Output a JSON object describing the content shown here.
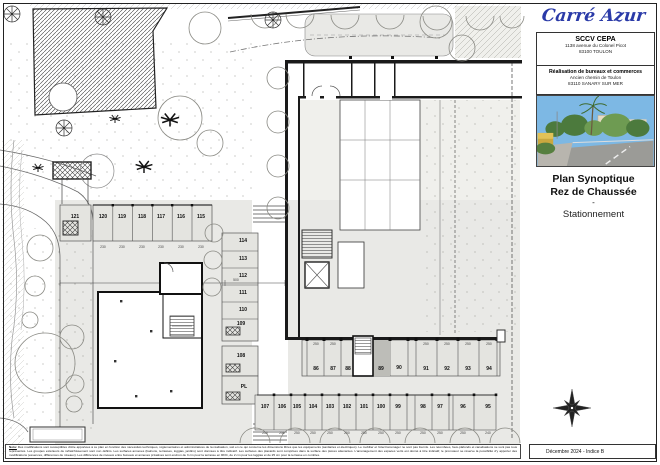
{
  "title_block": {
    "logo_text": "Carré Azur",
    "client_name": "SCCV CEPA",
    "client_address1": "1138 avenue du Colonel Picot",
    "client_address2": "83100 TOULON",
    "project_title": "Réalisation de bureaux et commerces",
    "project_address1": "Ancien chemin de Toulon",
    "project_address2": "83110 SANARY SUR MER",
    "drawing_title1": "Plan Synoptique",
    "drawing_title2": "Rez de Chaussée",
    "drawing_sep": "-",
    "drawing_subtitle": "Stationnement",
    "revision": "Décembre 2024 - Indice B"
  },
  "notes": {
    "label": "Nota:",
    "text": " Des modifications sont susceptibles d'être apportées à ce plan en fonction des nécessités techniques, réglementaires et administratives de la réalisation, soit en ce qui concerne les dimensions libres que les équipements (sanitaires et électriques). Le mobilier et l'électroménager ne sont pas fournis. Les retombées, faux-plafonds et canalisations ne sont pas tous représentés. Les groupes extérieurs de rafraîchissement sont non définis. Les surfaces annexes (balcons, terrasses, loggias, jardins) sont données à titre indicatif. Les surfaces des placards sont comprises dans la surface des pièces attenantes. L'aménagement des espaces verts est donné à titre indicatif, le promoteur se réserve la possibilité d'y apporter des modifications (essences, différences de niveaux). Les différences de niveaux entre bureaux et annexes privatives sont environ de 3 cm pour la terrasse en RDC, de 2 cm pour les loggias et de 25 cm pour la terrasse en combles."
  },
  "plan": {
    "labels": [
      {
        "t": "121",
        "x": 75,
        "y": 217,
        "k": "s"
      },
      {
        "t": "120",
        "x": 103,
        "y": 217,
        "k": "s"
      },
      {
        "t": "119",
        "x": 122,
        "y": 217,
        "k": "s"
      },
      {
        "t": "118",
        "x": 142,
        "y": 217,
        "k": "s"
      },
      {
        "t": "117",
        "x": 161,
        "y": 217,
        "k": "s"
      },
      {
        "t": "116",
        "x": 181,
        "y": 217,
        "k": "s"
      },
      {
        "t": "115",
        "x": 201,
        "y": 217,
        "k": "s"
      },
      {
        "t": "114",
        "x": 243,
        "y": 241,
        "k": "s"
      },
      {
        "t": "113",
        "x": 243,
        "y": 259,
        "k": "s"
      },
      {
        "t": "112",
        "x": 243,
        "y": 276,
        "k": "s"
      },
      {
        "t": "111",
        "x": 243,
        "y": 293,
        "k": "s"
      },
      {
        "t": "110",
        "x": 243,
        "y": 310,
        "k": "s"
      },
      {
        "t": "109",
        "x": 241,
        "y": 324,
        "k": "s"
      },
      {
        "t": "108",
        "x": 241,
        "y": 356,
        "k": "s"
      },
      {
        "t": "PL",
        "x": 244,
        "y": 387,
        "k": "s"
      },
      {
        "t": "86",
        "x": 316,
        "y": 369,
        "k": "s"
      },
      {
        "t": "87",
        "x": 333,
        "y": 369,
        "k": "s"
      },
      {
        "t": "88",
        "x": 348,
        "y": 369,
        "k": "s"
      },
      {
        "t": "89",
        "x": 381,
        "y": 369,
        "k": "s"
      },
      {
        "t": "90",
        "x": 399,
        "y": 368,
        "k": "s"
      },
      {
        "t": "91",
        "x": 426,
        "y": 369,
        "k": "s"
      },
      {
        "t": "92",
        "x": 447,
        "y": 369,
        "k": "s"
      },
      {
        "t": "93",
        "x": 468,
        "y": 369,
        "k": "s"
      },
      {
        "t": "94",
        "x": 489,
        "y": 369,
        "k": "s"
      },
      {
        "t": "107",
        "x": 265,
        "y": 407,
        "k": "s"
      },
      {
        "t": "106",
        "x": 282,
        "y": 407,
        "k": "s"
      },
      {
        "t": "105",
        "x": 297,
        "y": 407,
        "k": "s"
      },
      {
        "t": "104",
        "x": 313,
        "y": 407,
        "k": "s"
      },
      {
        "t": "103",
        "x": 330,
        "y": 407,
        "k": "s"
      },
      {
        "t": "102",
        "x": 347,
        "y": 407,
        "k": "s"
      },
      {
        "t": "101",
        "x": 364,
        "y": 407,
        "k": "s"
      },
      {
        "t": "100",
        "x": 381,
        "y": 407,
        "k": "s"
      },
      {
        "t": "99",
        "x": 398,
        "y": 407,
        "k": "s"
      },
      {
        "t": "98",
        "x": 423,
        "y": 407,
        "k": "s"
      },
      {
        "t": "97",
        "x": 440,
        "y": 407,
        "k": "s"
      },
      {
        "t": "96",
        "x": 463,
        "y": 407,
        "k": "s"
      },
      {
        "t": "95",
        "x": 488,
        "y": 407,
        "k": "s"
      },
      {
        "t": "230",
        "x": 103,
        "y": 247,
        "k": "d"
      },
      {
        "t": "230",
        "x": 122,
        "y": 247,
        "k": "d"
      },
      {
        "t": "230",
        "x": 142,
        "y": 247,
        "k": "d"
      },
      {
        "t": "230",
        "x": 161,
        "y": 247,
        "k": "d"
      },
      {
        "t": "230",
        "x": 181,
        "y": 247,
        "k": "d"
      },
      {
        "t": "230",
        "x": 201,
        "y": 247,
        "k": "d"
      },
      {
        "t": "250",
        "x": 316,
        "y": 344,
        "k": "d"
      },
      {
        "t": "250",
        "x": 333,
        "y": 344,
        "k": "d"
      },
      {
        "t": "250",
        "x": 426,
        "y": 344,
        "k": "d"
      },
      {
        "t": "250",
        "x": 447,
        "y": 344,
        "k": "d"
      },
      {
        "t": "250",
        "x": 468,
        "y": 344,
        "k": "d"
      },
      {
        "t": "250",
        "x": 489,
        "y": 344,
        "k": "d"
      },
      {
        "t": "250",
        "x": 265,
        "y": 433,
        "k": "d"
      },
      {
        "t": "250",
        "x": 282,
        "y": 433,
        "k": "d"
      },
      {
        "t": "250",
        "x": 297,
        "y": 433,
        "k": "d"
      },
      {
        "t": "250",
        "x": 313,
        "y": 433,
        "k": "d"
      },
      {
        "t": "250",
        "x": 330,
        "y": 433,
        "k": "d"
      },
      {
        "t": "250",
        "x": 347,
        "y": 433,
        "k": "d"
      },
      {
        "t": "250",
        "x": 364,
        "y": 433,
        "k": "d"
      },
      {
        "t": "250",
        "x": 381,
        "y": 433,
        "k": "d"
      },
      {
        "t": "250",
        "x": 398,
        "y": 433,
        "k": "d"
      },
      {
        "t": "250",
        "x": 423,
        "y": 433,
        "k": "d"
      },
      {
        "t": "250",
        "x": 440,
        "y": 433,
        "k": "d"
      },
      {
        "t": "250",
        "x": 463,
        "y": 433,
        "k": "d"
      },
      {
        "t": "240",
        "x": 488,
        "y": 433,
        "k": "d"
      },
      {
        "t": "500",
        "x": 236,
        "y": 280,
        "k": "d"
      }
    ]
  }
}
